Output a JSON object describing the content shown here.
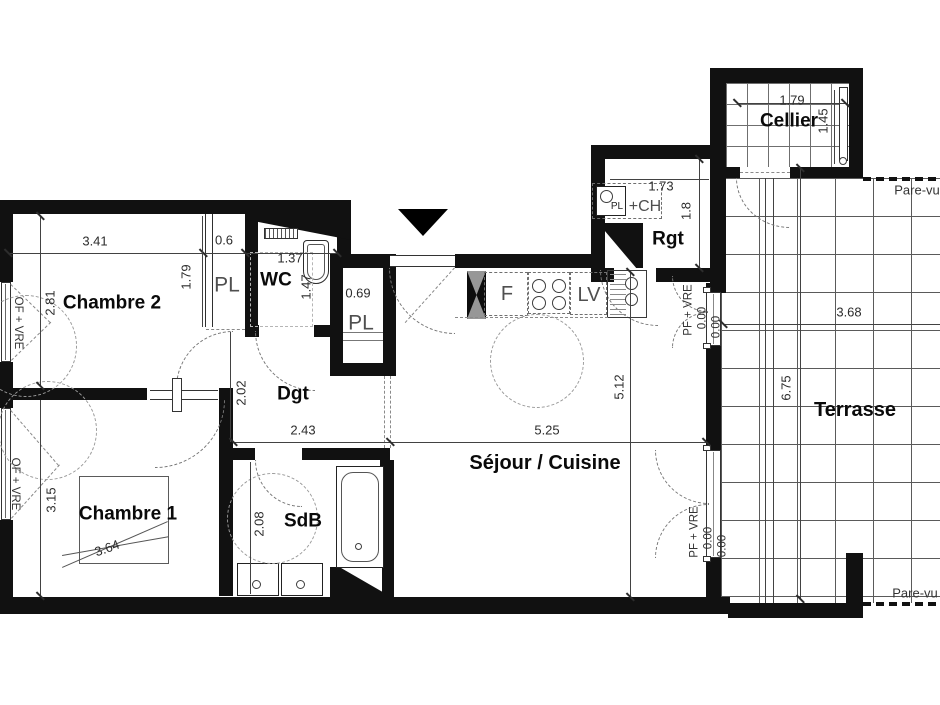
{
  "rooms": {
    "chambre2": "Chambre 2",
    "chambre1": "Chambre 1",
    "wc": "WC",
    "sdb": "SdB",
    "dgt": "Dgt",
    "sejour": "Séjour / Cuisine",
    "rgt": "Rgt",
    "cellier": "Cellier",
    "terrasse": "Terrasse",
    "pl_top": "PL",
    "pl_mid": "PL"
  },
  "dims": {
    "chambre2_w": "3.41",
    "chambre2_h": "2.81",
    "pl_top_w": "0.6",
    "pl_top_d": "1.79",
    "wc_w": "1.37",
    "wc_d": "1.47",
    "pl_mid_w": "0.69",
    "dgt_h": "2.02",
    "dgt_w": "2.43",
    "chambre1_h": "3.15",
    "chambre1_diag": "3.64",
    "sdb_h": "2.08",
    "sejour_w": "5.25",
    "sejour_h": "5.12",
    "rgt_w": "1.73",
    "rgt_h": "1.8",
    "cellier_w": "1.79",
    "cellier_h": "1.45",
    "terrasse_w": "3.68",
    "terrasse_h": "6.75"
  },
  "levels": {
    "upper_a": "0.00",
    "upper_b": "0.00",
    "lower_a": "0.00",
    "lower_b": "0.00"
  },
  "openings": {
    "chambre2_window": "OF + VRE",
    "chambre1_window": "OF + VRE",
    "terrace_door_upper": "PF + VRE",
    "terrace_door_lower": "PF + VRE"
  },
  "kitchen": {
    "fridge": "F",
    "dishwasher": "LV"
  },
  "rgt_fixture": {
    "boiler": "PL",
    "suffix": "+CH"
  },
  "screens": {
    "top": "Pare-vu",
    "bottom": "Pare-vu"
  },
  "colors": {
    "wall": "#111111",
    "line": "#424242",
    "dash": "#8a8a8a",
    "grid": "#5a5a5a"
  }
}
